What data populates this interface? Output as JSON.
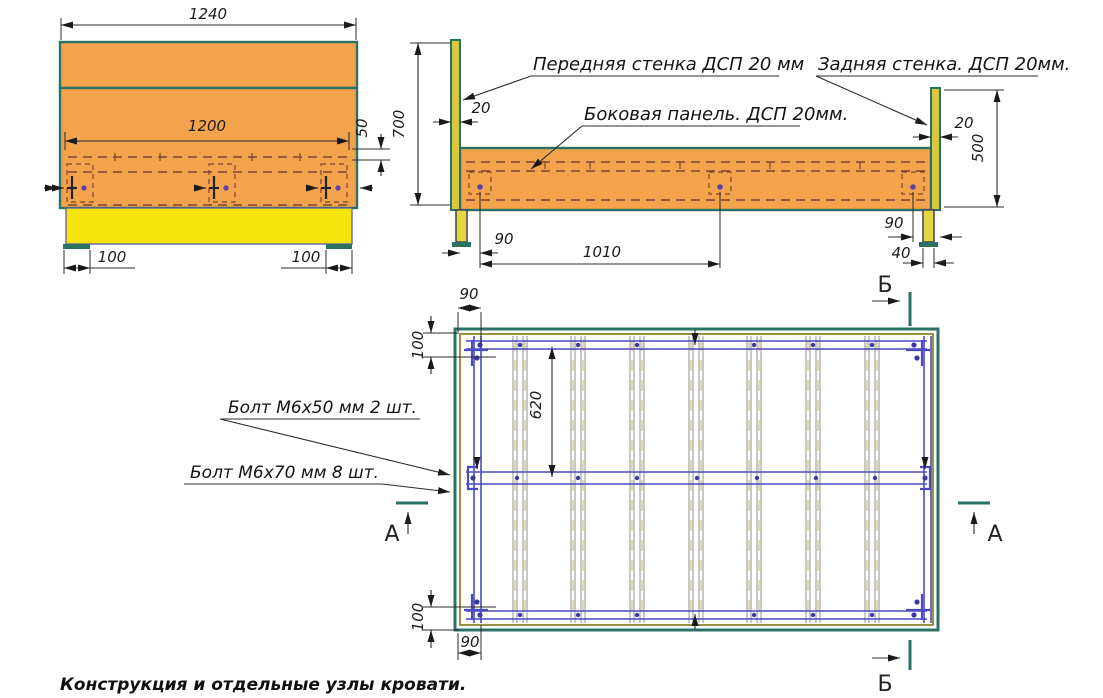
{
  "caption": "Конструкция и отдельные узлы кровати.",
  "front_view": {
    "dim_total_width": "1240",
    "dim_inner_width": "1200",
    "dim_rail_offset": "50",
    "dim_foot_left": "100",
    "dim_foot_right": "100"
  },
  "side_view": {
    "label_front_wall": "Передняя стенка ДСП 20 мм",
    "label_side_panel": "Боковая панель. ДСП 20мм.",
    "label_back_wall": "Задняя стенка. ДСП 20мм.",
    "dim_height": "700",
    "dim_front_thickness": "20",
    "dim_back_thickness": "20",
    "dim_back_height": "500",
    "dim_bolt_offset_front": "90",
    "dim_bolt_span": "1010",
    "dim_bolt_offset_back": "90",
    "dim_leg_width": "40"
  },
  "plan_view": {
    "label_bolt_m6x50": "Болт М6х50 мм  2 шт.",
    "label_bolt_m6x70": "Болт М6х70 мм  8 шт.",
    "dim_slat_offset_top": "90",
    "dim_rail_offset_top": "100",
    "dim_rail_spacing": "620",
    "dim_rail_offset_bottom": "100",
    "dim_slat_offset_bottom": "90",
    "section_a": "А",
    "section_b": "Б"
  },
  "colors": {
    "panel_orange": "#F4A34D",
    "base_yellow": "#F6E50C",
    "edge_teal": "#2A7265",
    "rail_blue": "#4A4AC2",
    "hidden_line_brown": "#7B4530",
    "bolt_purple": "#5B3FA8",
    "chipboard_core": "#D9C83E",
    "slat_grey": "#909090",
    "slat_core": "#D8D09A",
    "olive_line": "#8F8430"
  }
}
